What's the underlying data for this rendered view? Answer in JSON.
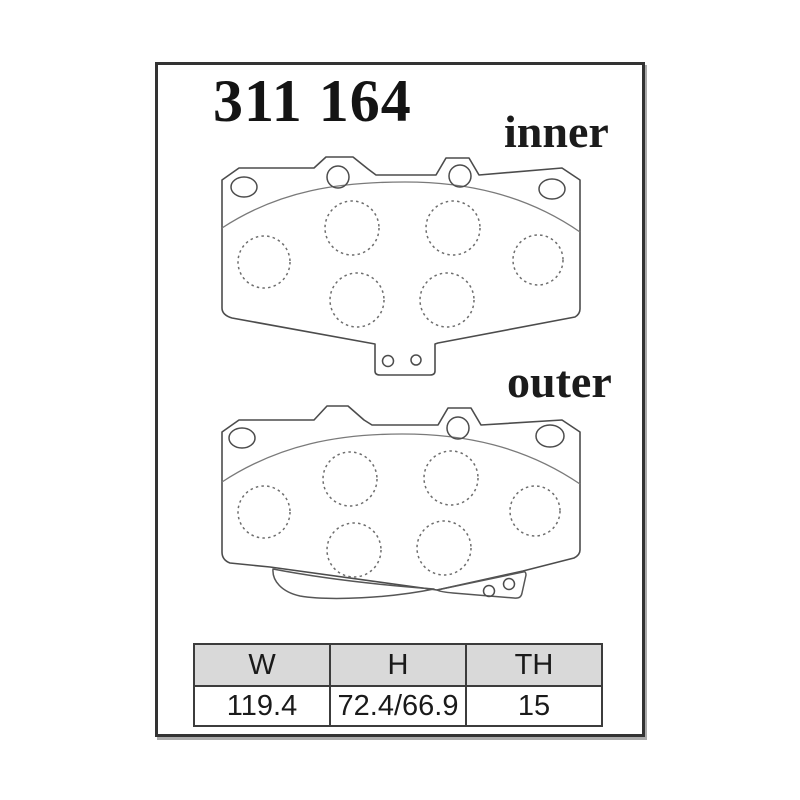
{
  "part_number": "311 164",
  "labels": {
    "inner": "inner",
    "outer": "outer"
  },
  "table": {
    "headers": [
      "W",
      "H",
      "TH"
    ],
    "values": [
      "119.4",
      "72.4/66.9",
      "15"
    ]
  },
  "drawing": {
    "type": "brake-pad-technical-drawing",
    "views": [
      "inner",
      "outer"
    ],
    "colors": {
      "line": "#4c4c4c",
      "dotted_line": "#6e6e6e",
      "frame_border": "#333333",
      "table_header_bg": "#d9d9d9",
      "background": "#ffffff"
    }
  }
}
